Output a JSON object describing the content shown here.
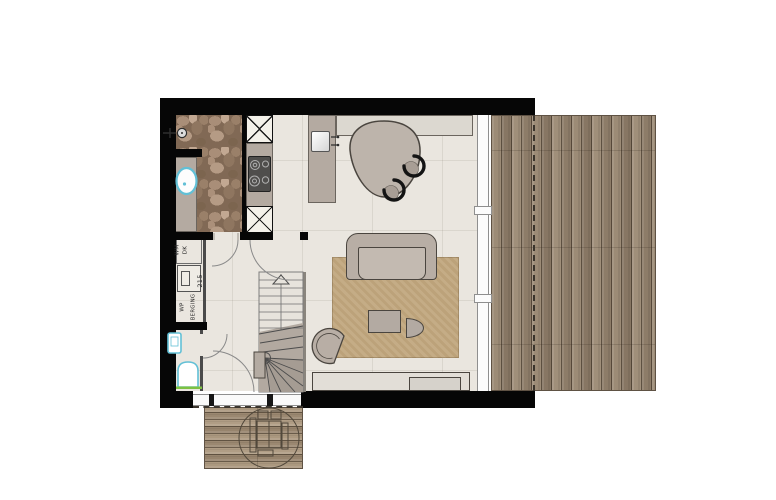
{
  "plan": {
    "labels": {
      "washer": "WM",
      "dryer": "DK",
      "dimension": "215",
      "heat_pump": "WP",
      "storage": "BERGING"
    },
    "colors": {
      "wall_black": "#060606",
      "interior_floor": "#eae6df",
      "bathroom_stone": "#816955",
      "cabinet_taupe": "#b4aaa1",
      "counter_light": "#dcd8d0",
      "furniture_taupe": "#b8aea5",
      "furniture_outline": "#4a453f",
      "rug_tan": "#c1a77e",
      "deck_wood": "#95846f",
      "sanitary_blue": "#62c0d6",
      "threshold_green": "#7dc142",
      "glass_frame": "#8f8f8f",
      "dashed_overhang": "#3a342c"
    },
    "icons": [
      "shower-icon",
      "washbasin-icon",
      "hand-basin-icon",
      "toilet-icon",
      "cooktop-icon",
      "kitchen-sink-icon",
      "kitchen-faucet-icon",
      "stairs-up-arrow-icon",
      "door-swing-arc",
      "picnic-table-icon",
      "shaft-x-icon",
      "overhang-dashed-line"
    ]
  }
}
